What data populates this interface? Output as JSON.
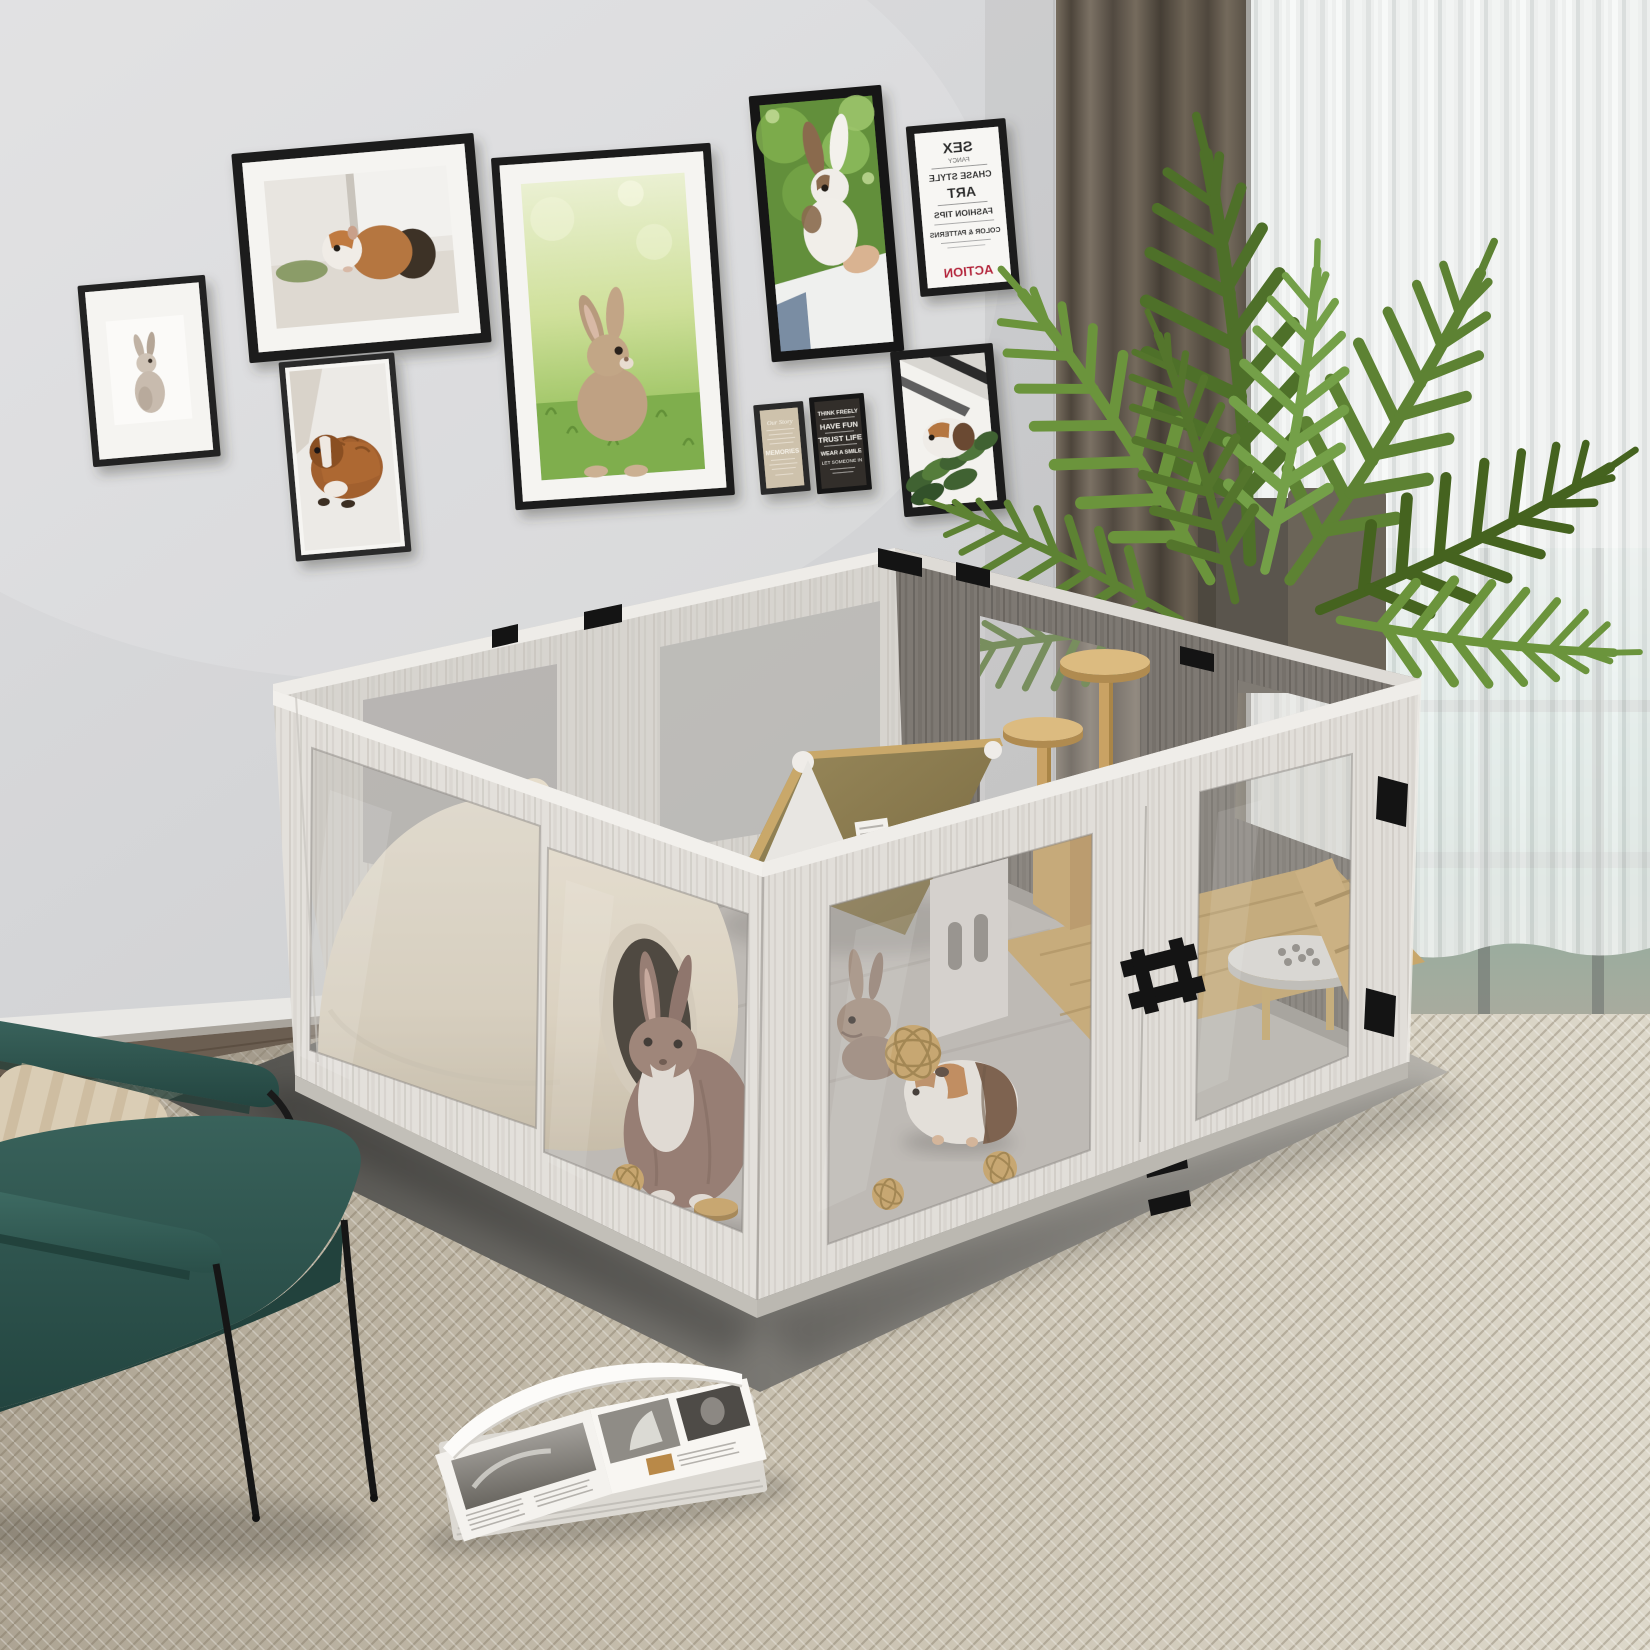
{
  "scene": {
    "setting": "living room with gallery wall of pet portraits",
    "product": "whitewashed wood small-animal playpen with clear acrylic windows"
  },
  "palette": {
    "wall": "#d8d8da",
    "rug": "#cfc8b9",
    "floor_mat_dark": "#55544f",
    "floor_mat_light": "#b5b2ab",
    "pen_wood_light": "#e3e0db",
    "pen_wood_dark": "#7e7973",
    "acrylic": "#b8b5b0",
    "hardware_black": "#161616",
    "curtain_taupe": "#675e51",
    "sheer_white": "#eef0ef",
    "window_view_teal": "#a5c8bf",
    "plant_green": "#5d8233",
    "chair_teal": "#2d544e",
    "pillow_beige": "#d9cdb5",
    "igloo_cream": "#e9e1d1",
    "roof_olive": "#8e7d4f",
    "wood_accent": "#c9a264",
    "rabbit_brown": "#8d6f63",
    "guinea_orange": "#b5763f"
  },
  "wall_art": {
    "frames": [
      {
        "id": "rabbit-watercolor",
        "subject": "gray rabbit illustration",
        "frame": "black",
        "mat": "white"
      },
      {
        "id": "guinea-pig-windowsill",
        "subject": "tan and white guinea pig on windowsill",
        "frame": "black",
        "mat": "white"
      },
      {
        "id": "guinea-pig-orange",
        "subject": "wet-look orange guinea pig on white bedding",
        "frame": "black",
        "mat": "none"
      },
      {
        "id": "bunny-on-grass",
        "subject": "tan bunny sitting on bright grass",
        "frame": "black",
        "mat": "white"
      },
      {
        "id": "rabbit-held",
        "subject": "rabbit held up against green foliage",
        "frame": "black",
        "mat": "none"
      },
      {
        "id": "typography-poster",
        "subject": "mirrored fashion word art",
        "frame": "black",
        "mat": "none"
      },
      {
        "id": "beige-quote",
        "subject": "beige word-art card",
        "frame": "black",
        "mat": "none"
      },
      {
        "id": "black-quote",
        "subject": "chalkboard quote card",
        "frame": "black",
        "mat": "none"
      },
      {
        "id": "guinea-pig-greenery",
        "subject": "guinea pig with pine greenery",
        "frame": "black",
        "mat": "none"
      }
    ],
    "typography_poster": {
      "mirrored": true,
      "accent_color": "#b5223a",
      "lines": [
        "SEX",
        "FANCY",
        "CHASE STYLE",
        "ART",
        "FASHION TIPS",
        "COLOR & PATTERNS",
        "ACTION"
      ]
    },
    "beige_quote": {
      "lines": [
        "Our Story",
        "MEMORIES"
      ]
    },
    "black_quote": {
      "lines": [
        "THINK FREELY",
        "HAVE FUN",
        "TRUST LIFE",
        "WEAR A SMILE",
        "LET SOMEONE IN"
      ]
    }
  },
  "playpen": {
    "material": "whitewash wood-grain panels",
    "windows": "clear acrylic",
    "hardware": "black slot clips and double-bar latch",
    "contents": [
      "cream igloo hide",
      "brown rabbit",
      "peeking rabbit",
      "a-frame house with olive roof",
      "wood cat tree with two round perches",
      "white round feeder",
      "rattan balls",
      "wood bowl",
      "bamboo mat"
    ]
  },
  "room": {
    "plant": "areca palm in dark planters",
    "curtains": [
      "taupe blackout curtain",
      "white sheer curtain"
    ],
    "chair": "teal accent chair with black metal legs",
    "pillow": "striped beige cushion",
    "magazine": "open fashion magazine on rug"
  }
}
